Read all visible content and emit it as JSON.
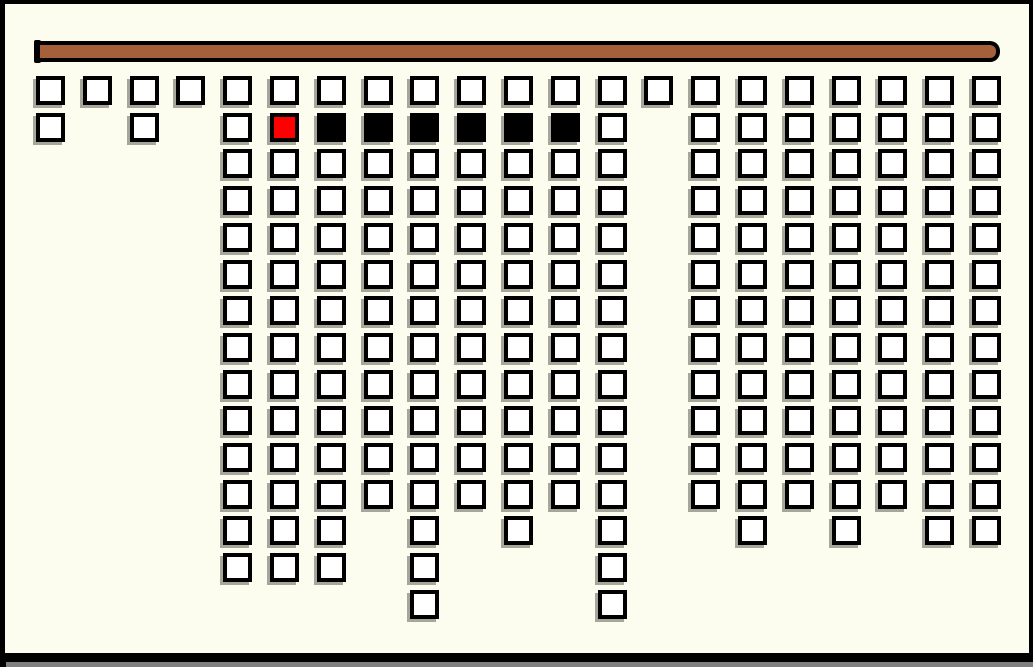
{
  "window": {
    "width": 1033,
    "height": 667,
    "background_color": "#FCFCEF",
    "frame_color": "#000000",
    "bottom_shadow_color": "#7F7F7F"
  },
  "rod": {
    "x": 35,
    "y": 41,
    "width": 965,
    "height": 21,
    "fill_color": "#A5603A",
    "outline_color": "#000000",
    "cap": {
      "x": 34,
      "y": 40,
      "width": 7,
      "height": 23
    }
  },
  "grid": {
    "origin_x": 36,
    "origin_y": 76,
    "col_spacing": 46.8,
    "row_spacing": 36.7,
    "cell_size": 29,
    "cell_border": 4,
    "columns": 21,
    "rows": 15,
    "cell_colors": {
      "white": "#FFFFFF",
      "red": "#FF0000",
      "black": "#000000"
    },
    "cell_outline_color": "#000000",
    "cell_shadow_color": "#A6A69A",
    "cells_by_row": [
      {
        "row": 0,
        "white": [
          0,
          1,
          2,
          3,
          4,
          5,
          6,
          7,
          8,
          9,
          10,
          11,
          12,
          13,
          14,
          15,
          16,
          17,
          18,
          19,
          20
        ]
      },
      {
        "row": 1,
        "white": [
          0,
          2,
          4,
          12,
          14,
          15,
          16,
          17,
          18,
          19,
          20
        ],
        "red": [
          5
        ],
        "black": [
          6,
          7,
          8,
          9,
          10,
          11
        ]
      },
      {
        "row": 2,
        "white": [
          4,
          5,
          6,
          7,
          8,
          9,
          10,
          11,
          12,
          14,
          15,
          16,
          17,
          18,
          19,
          20
        ]
      },
      {
        "row": 3,
        "white": [
          4,
          5,
          6,
          7,
          8,
          9,
          10,
          11,
          12,
          14,
          15,
          16,
          17,
          18,
          19,
          20
        ]
      },
      {
        "row": 4,
        "white": [
          4,
          5,
          6,
          7,
          8,
          9,
          10,
          11,
          12,
          14,
          15,
          16,
          17,
          18,
          19,
          20
        ]
      },
      {
        "row": 5,
        "white": [
          4,
          5,
          6,
          7,
          8,
          9,
          10,
          11,
          12,
          14,
          15,
          16,
          17,
          18,
          19,
          20
        ]
      },
      {
        "row": 6,
        "white": [
          4,
          5,
          6,
          7,
          8,
          9,
          10,
          11,
          12,
          14,
          15,
          16,
          17,
          18,
          19,
          20
        ]
      },
      {
        "row": 7,
        "white": [
          4,
          5,
          6,
          7,
          8,
          9,
          10,
          11,
          12,
          14,
          15,
          16,
          17,
          18,
          19,
          20
        ]
      },
      {
        "row": 8,
        "white": [
          4,
          5,
          6,
          7,
          8,
          9,
          10,
          11,
          12,
          14,
          15,
          16,
          17,
          18,
          19,
          20
        ]
      },
      {
        "row": 9,
        "white": [
          4,
          5,
          6,
          7,
          8,
          9,
          10,
          11,
          12,
          14,
          15,
          16,
          17,
          18,
          19,
          20
        ]
      },
      {
        "row": 10,
        "white": [
          4,
          5,
          6,
          7,
          8,
          9,
          10,
          11,
          12,
          14,
          15,
          16,
          17,
          18,
          19,
          20
        ]
      },
      {
        "row": 11,
        "white": [
          4,
          5,
          6,
          7,
          8,
          9,
          10,
          11,
          12,
          14,
          15,
          16,
          17,
          18,
          19,
          20
        ]
      },
      {
        "row": 12,
        "white": [
          4,
          5,
          6,
          8,
          10,
          12,
          15,
          17,
          19,
          20
        ]
      },
      {
        "row": 13,
        "white": [
          4,
          5,
          6,
          8,
          12
        ]
      },
      {
        "row": 14,
        "white": [
          8,
          12
        ]
      }
    ],
    "tile_counts": {
      "total": 216,
      "white": 209,
      "red": 1,
      "black": 6
    }
  }
}
